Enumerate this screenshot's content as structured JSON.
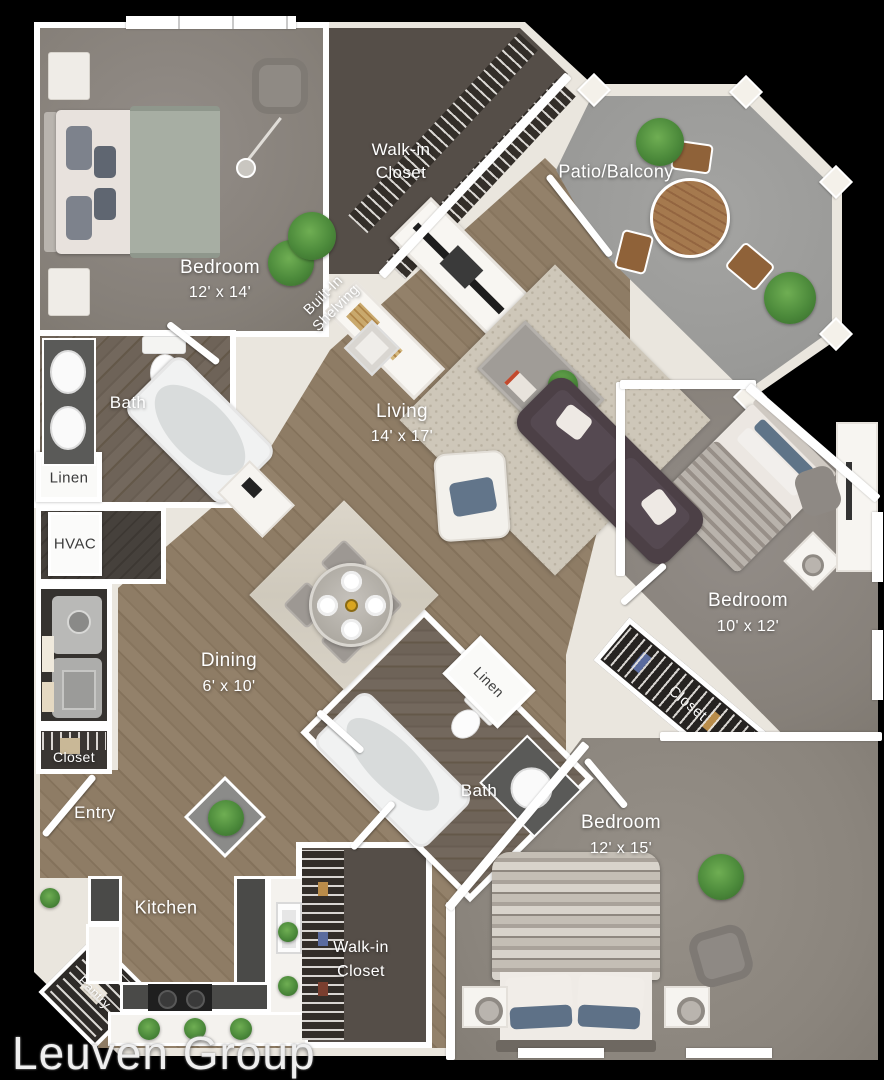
{
  "watermark": {
    "text": "Leuven Group"
  },
  "rooms": {
    "bedroom_top_left": {
      "name": "Bedroom",
      "dims": "12' x 14'"
    },
    "walk_in_closet_top": {
      "name_line1": "Walk-in",
      "name_line2": "Closet"
    },
    "patio_balcony": {
      "name": "Patio/Balcony"
    },
    "built_in_shelving": {
      "name_line1": "Built-In",
      "name_line2": "Shelving"
    },
    "bath_upper": {
      "name": "Bath"
    },
    "linen_upper": {
      "name": "Linen"
    },
    "hvac": {
      "name": "HVAC"
    },
    "living": {
      "name": "Living",
      "dims": "14' x 17'"
    },
    "dining": {
      "name": "Dining",
      "dims": "6' x 10'"
    },
    "bedroom_right": {
      "name": "Bedroom",
      "dims": "10' x 12'"
    },
    "closet_right": {
      "name": "Closet"
    },
    "linen_lower": {
      "name": "Linen"
    },
    "bath_lower": {
      "name": "Bath"
    },
    "bedroom_bottom_right": {
      "name": "Bedroom",
      "dims": "12' x 15'"
    },
    "entry": {
      "name": "Entry"
    },
    "closet_entry": {
      "name": "Closet"
    },
    "kitchen": {
      "name": "Kitchen"
    },
    "pantry": {
      "name": "Pantry"
    },
    "walk_in_closet_bottom": {
      "name_line1": "Walk-in",
      "name_line2": "Closet"
    }
  },
  "colors": {
    "background": "#000000",
    "wall": "#ffffff",
    "outer_wall": "#eae6de",
    "wood_floor": "#8a785f",
    "dark_wood_floor": "#6b6055",
    "carpet": "#8d8781",
    "closet_floor": "#554e48",
    "patio_concrete": "#9e9e9c",
    "sofa": "#4c4046",
    "plant_green": "#4f9340",
    "accent_blue": "#5e7187",
    "counter_dark": "#4a4a48"
  }
}
